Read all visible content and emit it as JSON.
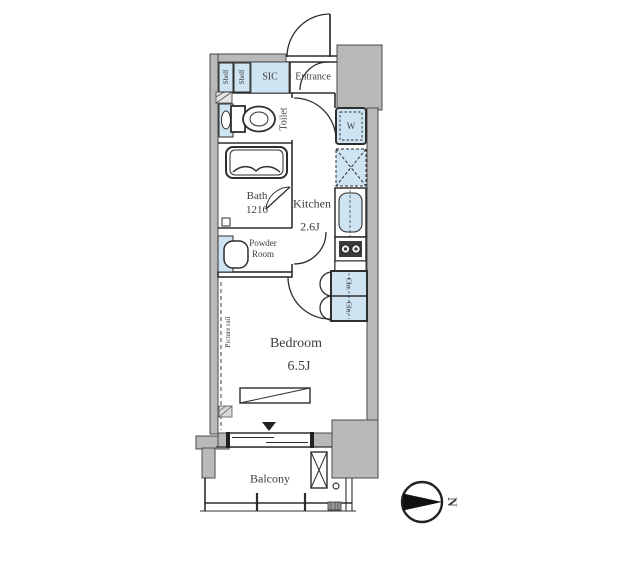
{
  "plan": {
    "rooms": {
      "sic": "SIC",
      "entrance": "Entrance",
      "toilet": "Toilet",
      "bath_name": "Bath",
      "bath_size": "1216",
      "powder_line1": "Powder",
      "powder_line2": "Room",
      "kitchen_name": "Kitchen",
      "kitchen_size": "2.6J",
      "bedroom_name": "Bedroom",
      "bedroom_size": "6.5J",
      "balcony": "Balcony"
    },
    "fixtures": {
      "shelf_top": "Shelf",
      "shelf_bottom": "Shelf",
      "washer": "W",
      "closet_top": "Clo.",
      "closet_bottom": "Clo."
    },
    "annotations": {
      "picture_rail": "Picture rail",
      "north": "N"
    },
    "colors": {
      "fixture_blue": "#cfe4f3",
      "wall_gray": "#b9b9b9",
      "line_dark": "#2e2e2e"
    }
  }
}
